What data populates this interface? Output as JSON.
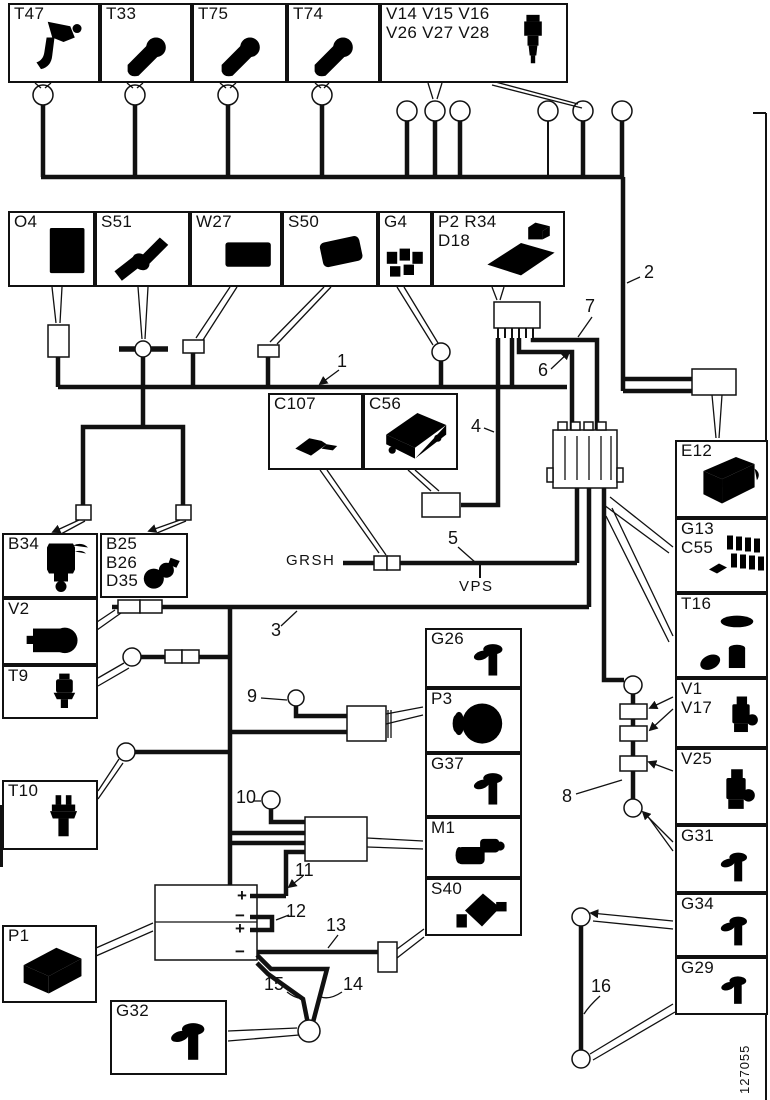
{
  "figure": {
    "number": "127055"
  },
  "colors": {
    "line": "#111111",
    "background": "#ffffff"
  },
  "components": {
    "t47": {
      "label": "T47"
    },
    "t33": {
      "label": "T33"
    },
    "t75": {
      "label": "T75"
    },
    "t74": {
      "label": "T74"
    },
    "injectors": {
      "label": "V14 V15 V16\nV26 V27 V28"
    },
    "o4": {
      "label": "O4"
    },
    "s51": {
      "label": "S51"
    },
    "w27": {
      "label": "W27"
    },
    "s50": {
      "label": "S50"
    },
    "g4": {
      "label": "G4"
    },
    "p2r34d18": {
      "label": "P2 R34\nD18"
    },
    "c107": {
      "label": "C107"
    },
    "c56": {
      "label": "C56"
    },
    "e12": {
      "label": "E12"
    },
    "g13c55": {
      "label": "G13\nC55"
    },
    "t16": {
      "label": "T16"
    },
    "v1v17": {
      "label": "V1\nV17"
    },
    "v25": {
      "label": "V25"
    },
    "g31": {
      "label": "G31"
    },
    "g34": {
      "label": "G34"
    },
    "g29": {
      "label": "G29"
    },
    "b34": {
      "label": "B34"
    },
    "b25b26d35": {
      "label": "B25\nB26\nD35"
    },
    "v2": {
      "label": "V2"
    },
    "t9": {
      "label": "T9"
    },
    "t10": {
      "label": "T10"
    },
    "p1": {
      "label": "P1"
    },
    "g32": {
      "label": "G32"
    },
    "g26": {
      "label": "G26"
    },
    "p3": {
      "label": "P3"
    },
    "g37": {
      "label": "G37"
    },
    "m1": {
      "label": "M1"
    },
    "s40": {
      "label": "S40"
    }
  },
  "wire_numbers": {
    "w1": "1",
    "w2": "2",
    "w3": "3",
    "w4": "4",
    "w5": "5",
    "w6": "6",
    "w7": "7",
    "w8": "8",
    "w9": "9",
    "w10": "10",
    "w11": "11",
    "w12": "12",
    "w13": "13",
    "w14": "14",
    "w15": "15",
    "w16": "16"
  },
  "net_labels": {
    "grsh": "GRSH",
    "vps": "VPS"
  },
  "battery": {
    "terminals": [
      "+",
      "−",
      "+",
      "−"
    ]
  }
}
